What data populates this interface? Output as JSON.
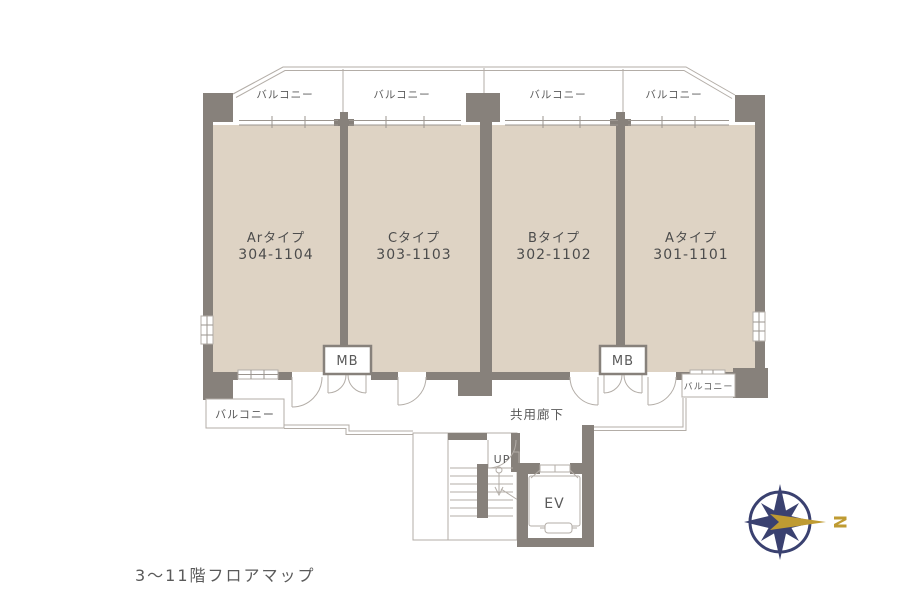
{
  "caption": {
    "text": "3〜11階フロアマップ"
  },
  "units": [
    {
      "type_label": "Arタイプ",
      "room_numbers": "304-1104"
    },
    {
      "type_label": "Cタイプ",
      "room_numbers": "303-1103"
    },
    {
      "type_label": "Bタイプ",
      "room_numbers": "302-1102"
    },
    {
      "type_label": "Aタイプ",
      "room_numbers": "301-1101"
    }
  ],
  "balconies": {
    "top_labels": [
      "バルコニー",
      "バルコニー",
      "バルコニー",
      "バルコニー"
    ],
    "bottom_left_label": "バルコニー",
    "bottom_right_label": "バルコニー"
  },
  "corridor": {
    "label": "共用廊下"
  },
  "meter_boxes": {
    "labels": [
      "MB",
      "MB"
    ]
  },
  "stairs": {
    "up_label": "UP"
  },
  "elevator": {
    "label": "EV"
  },
  "compass": {
    "north_label": "N"
  },
  "colors": {
    "bg": "#ffffff",
    "wall": "#87817b",
    "room_fill": "#ded3c4",
    "line": "#b3ada7",
    "line_dark": "#9b958f",
    "text_dark": "#4c4c4c",
    "text_mid": "#5a5a5a",
    "compass_navy": "#3a4170",
    "compass_gold": "#bf9b32"
  }
}
